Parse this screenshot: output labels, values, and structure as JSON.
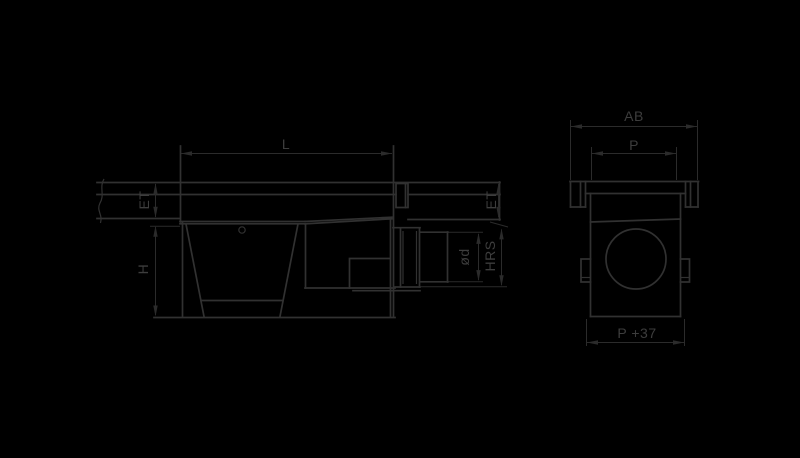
{
  "colors": {
    "background": "#000000",
    "line": "#313131",
    "dim_line": "#2b2b2b",
    "text": "#3d3d3d"
  },
  "drawing": {
    "type": "technical-drawing",
    "views": [
      {
        "id": "side-view",
        "description": "channel run with sump unit, outlet pipe",
        "dimension_labels": [
          "L",
          "ET",
          "H",
          "ET",
          "ød",
          "HRS"
        ]
      },
      {
        "id": "end-view",
        "description": "channel cross section with pipe opening",
        "dimension_labels": [
          "AB",
          "P",
          "P +37"
        ]
      }
    ]
  },
  "labels": {
    "side": {
      "length": "L",
      "et_left": "ET",
      "height": "H",
      "et_right": "ET",
      "pipe_diameter": "ød",
      "outlet_height": "HRS"
    },
    "end": {
      "overall_width": "AB",
      "width": "P",
      "base_width": "P +37"
    }
  }
}
